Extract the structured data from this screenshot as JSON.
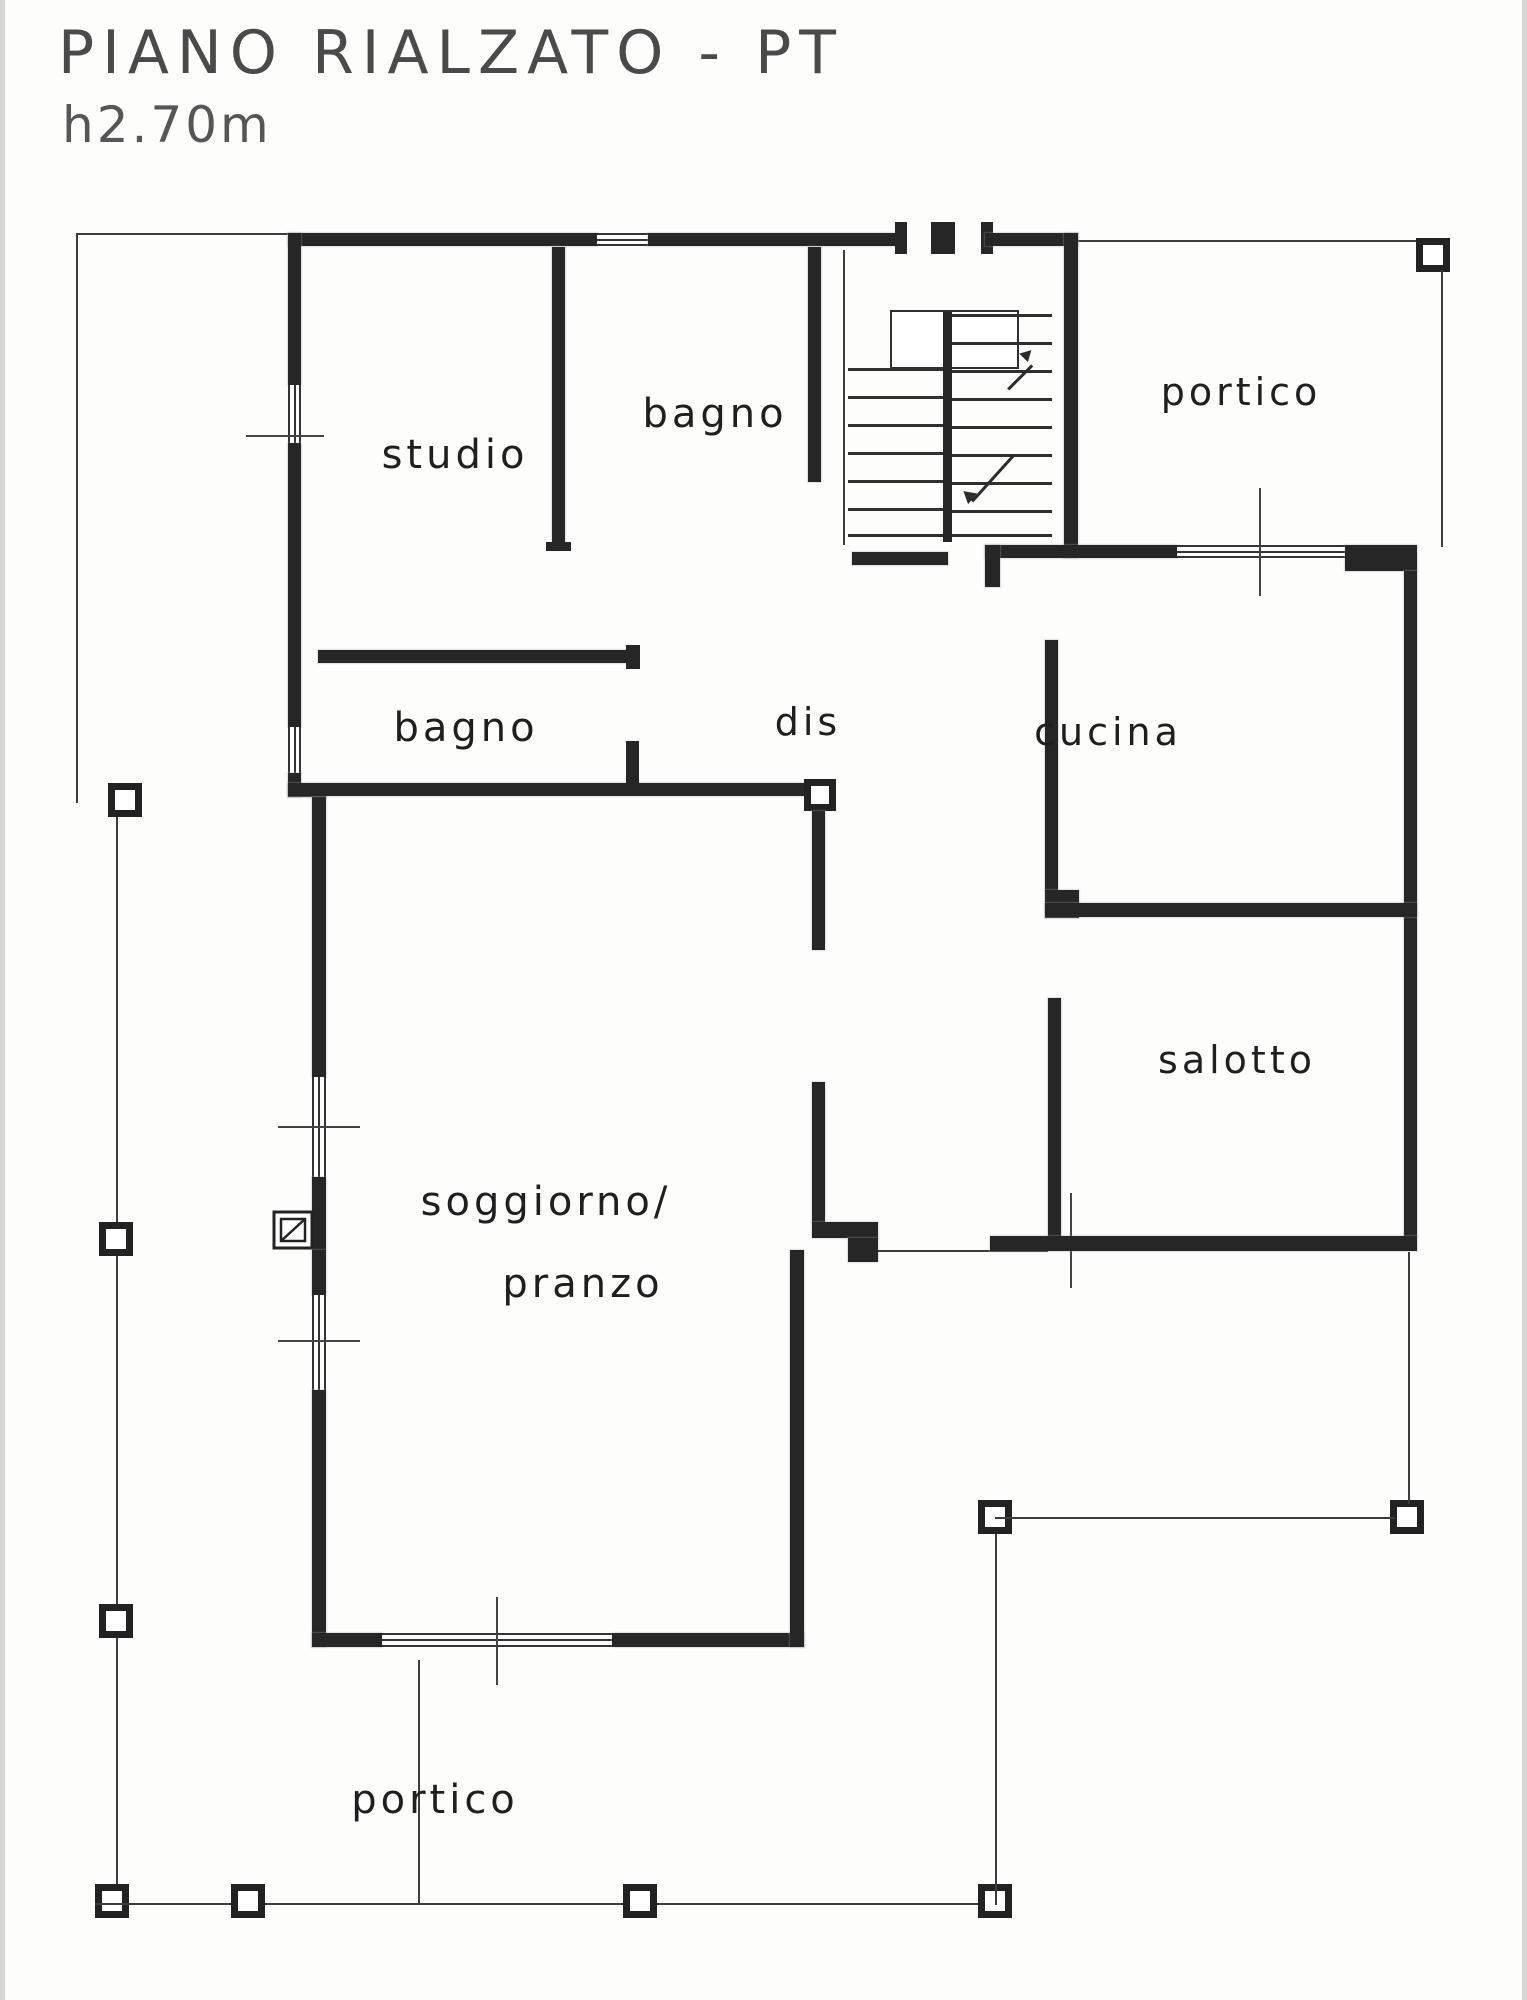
{
  "header": {
    "title": "PIANO RIALZATO - PT",
    "subtitle": "h2.70m"
  },
  "rooms": {
    "studio": "studio",
    "bagno_top": "bagno",
    "portico_top": "portico",
    "bagno_mid": "bagno",
    "dis": "dis",
    "cucina": "cucina",
    "salotto": "salotto",
    "soggiorno_line1": "soggiorno/",
    "soggiorno_line2": "pranzo",
    "portico_bottom": "portico"
  }
}
